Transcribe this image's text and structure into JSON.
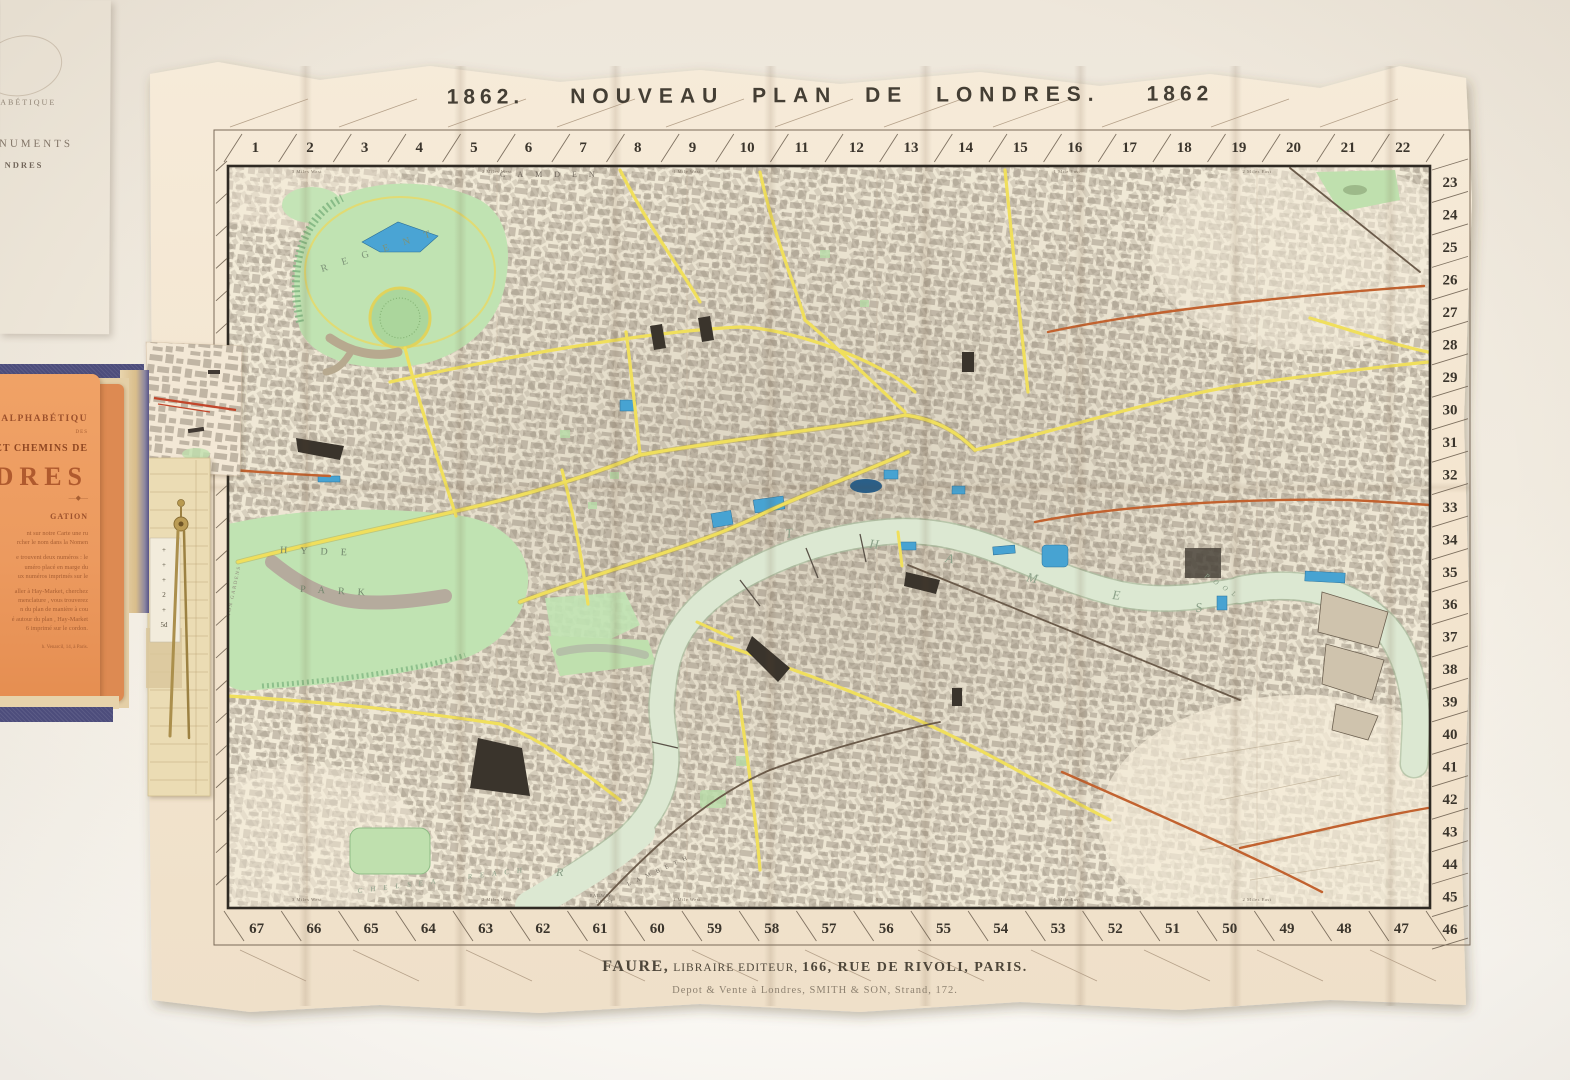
{
  "map_sheet": {
    "title": {
      "year_left": "1862.",
      "main": "NOUVEAU PLAN DE LONDRES.",
      "year_right": "1862"
    },
    "imprint": {
      "publisher_name": "FAURE,",
      "publisher_role": "LIBRAIRE EDITEUR,",
      "publisher_address": "166, RUE DE RIVOLI, PARIS.",
      "depot_line": "Depot & Vente à Londres, SMITH & SON, Strand, 172."
    },
    "grid_numbers": {
      "top": [
        1,
        2,
        3,
        4,
        5,
        6,
        7,
        8,
        9,
        10,
        11,
        12,
        13,
        14,
        15,
        16,
        17,
        18,
        19,
        20,
        21,
        22
      ],
      "right": [
        23,
        24,
        25,
        26,
        27,
        28,
        29,
        30,
        31,
        32,
        33,
        34,
        35,
        36,
        37,
        38,
        39,
        40,
        41,
        42,
        43,
        44,
        45,
        46
      ],
      "bottom": [
        67,
        66,
        65,
        64,
        63,
        62,
        61,
        60,
        59,
        58,
        57,
        56,
        55,
        54,
        53,
        52,
        51,
        50,
        49,
        48,
        47
      ]
    },
    "mile_markers": {
      "top": [
        {
          "label": "3 Miles West",
          "x": 307
        },
        {
          "label": "2 Miles West",
          "x": 497
        },
        {
          "label": "1 Mile West",
          "x": 687
        },
        {
          "label": "1 Mile East",
          "x": 1067
        },
        {
          "label": "2 Miles East",
          "x": 1257
        }
      ],
      "bottom": [
        {
          "label": "3 Miles West",
          "x": 307
        },
        {
          "label": "2 Miles West",
          "x": 497
        },
        {
          "label": "1 Mile West",
          "x": 687
        },
        {
          "label": "0",
          "x": 877
        },
        {
          "label": "1 Mile East",
          "x": 1067
        },
        {
          "label": "2 Miles East",
          "x": 1257
        }
      ]
    },
    "place_labels": [
      {
        "text": "CAMDEN",
        "x": 500,
        "y": 177,
        "size": 8,
        "spacing": 12,
        "rotate": 0,
        "color": "#6f675c",
        "italic": false
      },
      {
        "text": "REGENT",
        "x": 322,
        "y": 272,
        "size": 10,
        "spacing": 15,
        "rotate": -18,
        "color": "#7d9378",
        "italic": false
      },
      {
        "text": "HYDE",
        "x": 280,
        "y": 553,
        "size": 10,
        "spacing": 13,
        "rotate": 2,
        "color": "#72876d",
        "italic": false
      },
      {
        "text": "PARK",
        "x": 300,
        "y": 592,
        "size": 10,
        "spacing": 13,
        "rotate": 3,
        "color": "#72876d",
        "italic": false
      },
      {
        "text": "KENSINGTON GARDENS",
        "x": 223,
        "y": 648,
        "size": 5,
        "spacing": 1.5,
        "rotate": -78,
        "color": "#8b8277",
        "italic": false
      },
      {
        "text": "T",
        "x": 786,
        "y": 538,
        "size": 13,
        "spacing": 0,
        "rotate": -8,
        "color": "#8ca189",
        "italic": true
      },
      {
        "text": "H",
        "x": 869,
        "y": 548,
        "size": 13,
        "spacing": 0,
        "rotate": 5,
        "color": "#8ca189",
        "italic": true
      },
      {
        "text": "A",
        "x": 945,
        "y": 562,
        "size": 13,
        "spacing": 0,
        "rotate": 10,
        "color": "#8ca189",
        "italic": true
      },
      {
        "text": "M",
        "x": 1026,
        "y": 581,
        "size": 13,
        "spacing": 0,
        "rotate": 12,
        "color": "#8ca189",
        "italic": true
      },
      {
        "text": "E",
        "x": 1112,
        "y": 599,
        "size": 13,
        "spacing": 0,
        "rotate": 5,
        "color": "#8ca189",
        "italic": true
      },
      {
        "text": "S",
        "x": 1196,
        "y": 612,
        "size": 13,
        "spacing": 0,
        "rotate": -6,
        "color": "#8ca189",
        "italic": true
      },
      {
        "text": "POOL",
        "x": 1204,
        "y": 577,
        "size": 7,
        "spacing": 6,
        "rotate": 33,
        "color": "#8ca189",
        "italic": true
      },
      {
        "text": "CHELSEA",
        "x": 358,
        "y": 893,
        "size": 7,
        "spacing": 8,
        "rotate": -7,
        "color": "#8ca189",
        "italic": true
      },
      {
        "text": "REACH",
        "x": 468,
        "y": 879,
        "size": 7,
        "spacing": 8,
        "rotate": -7,
        "color": "#8ca189",
        "italic": true
      },
      {
        "text": "R",
        "x": 556,
        "y": 876,
        "size": 12,
        "spacing": 0,
        "rotate": 0,
        "color": "#8ca189",
        "italic": true
      },
      {
        "text": "LAMBETH",
        "x": 628,
        "y": 886,
        "size": 6,
        "spacing": 6,
        "rotate": -24,
        "color": "#6f675c",
        "italic": false
      },
      {
        "text": "RAILWAY",
        "x": 590,
        "y": 897,
        "size": 4,
        "spacing": 0.5,
        "rotate": 0,
        "color": "#6f675c",
        "italic": false
      },
      {
        "text": "DEPOT",
        "x": 596,
        "y": 903,
        "size": 4,
        "spacing": 1,
        "rotate": 0,
        "color": "#6f675c",
        "italic": false
      }
    ],
    "colors": {
      "paper": "#f4e7d3",
      "plate_line": "#2f2a23",
      "river": "#dce8d2",
      "river_edge": "#a3bc9d",
      "park": "#bfe2b1",
      "park_dark": "#74a877",
      "water_blue": "#47a3d2",
      "road_yellow": "#eedd55",
      "rail_orange": "#c2622f",
      "street_texture": "#93887a",
      "number_ink": "#3b352c",
      "title_ink": "#443e34"
    }
  },
  "booklet": {
    "cover_color": "#4d4d7c",
    "orange_page": {
      "color": "#ec9a5f",
      "title_fragment_top": "E ALPHABÉTIQU",
      "subtitle_fragment": "DES",
      "title_fragment_mid": "S ET CHEMINS DE",
      "title_fragment_large": "DRES",
      "rule_glyph": "—◆—",
      "section_heading_fragment": "GATION",
      "paragraph_fragments": [
        "nt sur notre Carte une ru",
        "rcher le nom dans la Nomen",
        "",
        "e trouvent deux numéros : le",
        "uméro placé en marge du",
        "ux numéros imprimés sur le",
        "",
        "aller à Hay-Market, cherchez",
        "menclature , vous trouverez",
        "n du plan de manière à cou",
        "é autour du plan , Hay-Market",
        "6 imprimé sur le cordon."
      ],
      "footer_fragment": "h. Venarcil, 14, à Paris."
    },
    "scale_strip": {
      "marks": [
        "+",
        "+",
        "+",
        "2",
        "+",
        "5d"
      ]
    },
    "pamphlet": {
      "color": "#efe8db",
      "line1": "HABÉTIQUE",
      "line2": "MONUMENTS",
      "line3": "NDRES"
    }
  }
}
